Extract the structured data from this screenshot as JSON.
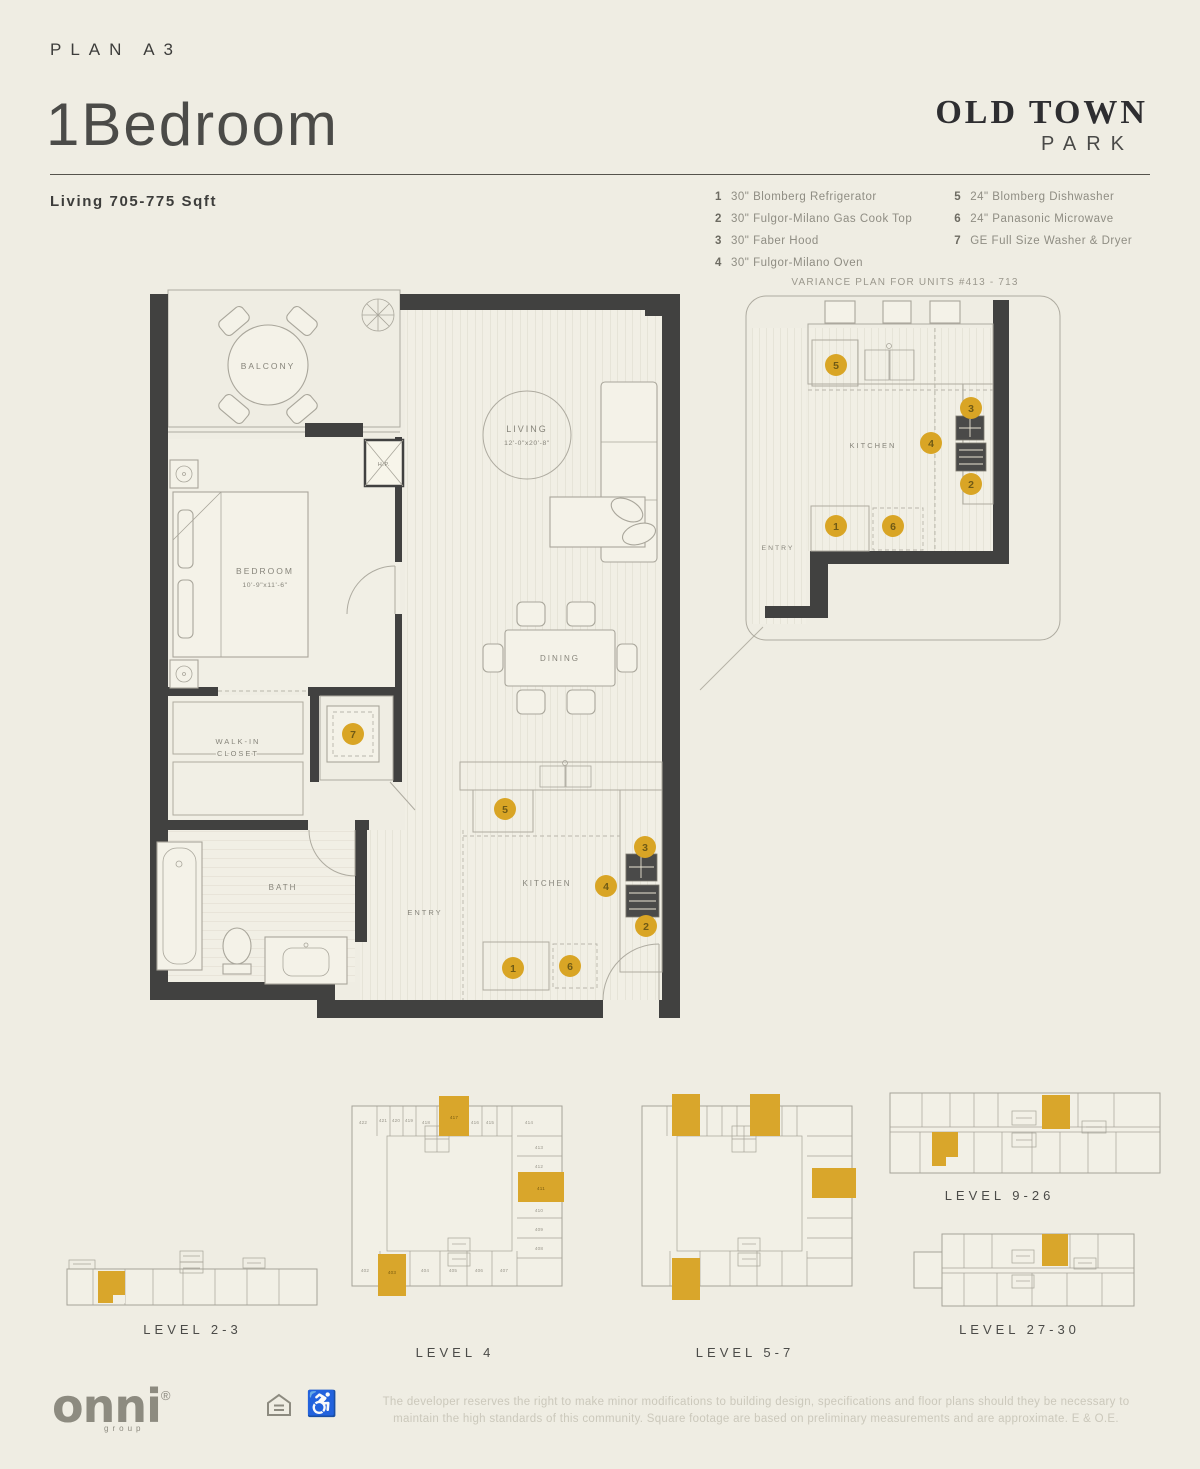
{
  "header": {
    "plan_label": "PLAN A3",
    "title": "1Bedroom",
    "sqft": "Living 705-775 Sqft",
    "brand_top": "OLD TOWN",
    "brand_bottom": "PARK"
  },
  "legend": {
    "items_left": [
      {
        "num": "1",
        "label": "30\" Blomberg Refrigerator"
      },
      {
        "num": "2",
        "label": "30\" Fulgor-Milano Gas Cook Top"
      },
      {
        "num": "3",
        "label": "30\" Faber Hood"
      },
      {
        "num": "4",
        "label": "30\" Fulgor-Milano Oven"
      }
    ],
    "items_right": [
      {
        "num": "5",
        "label": "24\" Blomberg Dishwasher"
      },
      {
        "num": "6",
        "label": "24\" Panasonic Microwave"
      },
      {
        "num": "7",
        "label": "GE Full Size Washer & Dryer"
      }
    ]
  },
  "variance_title": "VARIANCE PLAN FOR UNITS #413 - 713",
  "floorplan": {
    "balcony": "BALCONY",
    "living": "LIVING",
    "living_dim": "12'-0\"x20'-8\"",
    "bedroom": "BEDROOM",
    "bedroom_dim": "10'-9\"x11'-6\"",
    "walk_in_1": "WALK-IN",
    "walk_in_2": "CLOSET",
    "bath": "BATH",
    "entry": "ENTRY",
    "dining": "DINING",
    "kitchen": "KITCHEN",
    "hp": "H.P."
  },
  "variance_plan": {
    "kitchen": "KITCHEN",
    "entry": "ENTRY"
  },
  "markers": {
    "m1": "1",
    "m2": "2",
    "m3": "3",
    "m4": "4",
    "m5": "5",
    "m6": "6",
    "m7": "7"
  },
  "levels": {
    "level23": {
      "label": "LEVEL 2-3"
    },
    "level4": {
      "label": "LEVEL 4",
      "units_top": [
        "422",
        "421",
        "420",
        "419",
        "418",
        "417",
        "416",
        "415",
        "414"
      ],
      "units_right": [
        "413",
        "412",
        "411",
        "410",
        "409",
        "408"
      ],
      "units_bottom": [
        "402",
        "403",
        "404",
        "405",
        "406",
        "407"
      ]
    },
    "level57": {
      "label": "LEVEL 5-7"
    },
    "level926": {
      "label": "LEVEL 9-26"
    },
    "level2730": {
      "label": "LEVEL 27-30"
    }
  },
  "footer": {
    "logo": "onni",
    "logo_reg": "®",
    "logo_sub": "group",
    "disclaimer_1": "The developer reserves the right to make minor modifications to building design, specifications and floor plans should they be necessary to",
    "disclaimer_2": "maintain the high standards of this community. Square footage are based on preliminary measurements and are approximate. E & O.E."
  },
  "colors": {
    "accent": "#D9A525",
    "highlight_unit": "#D9A62B",
    "wall": "#414140",
    "background": "#EFEDE3"
  }
}
